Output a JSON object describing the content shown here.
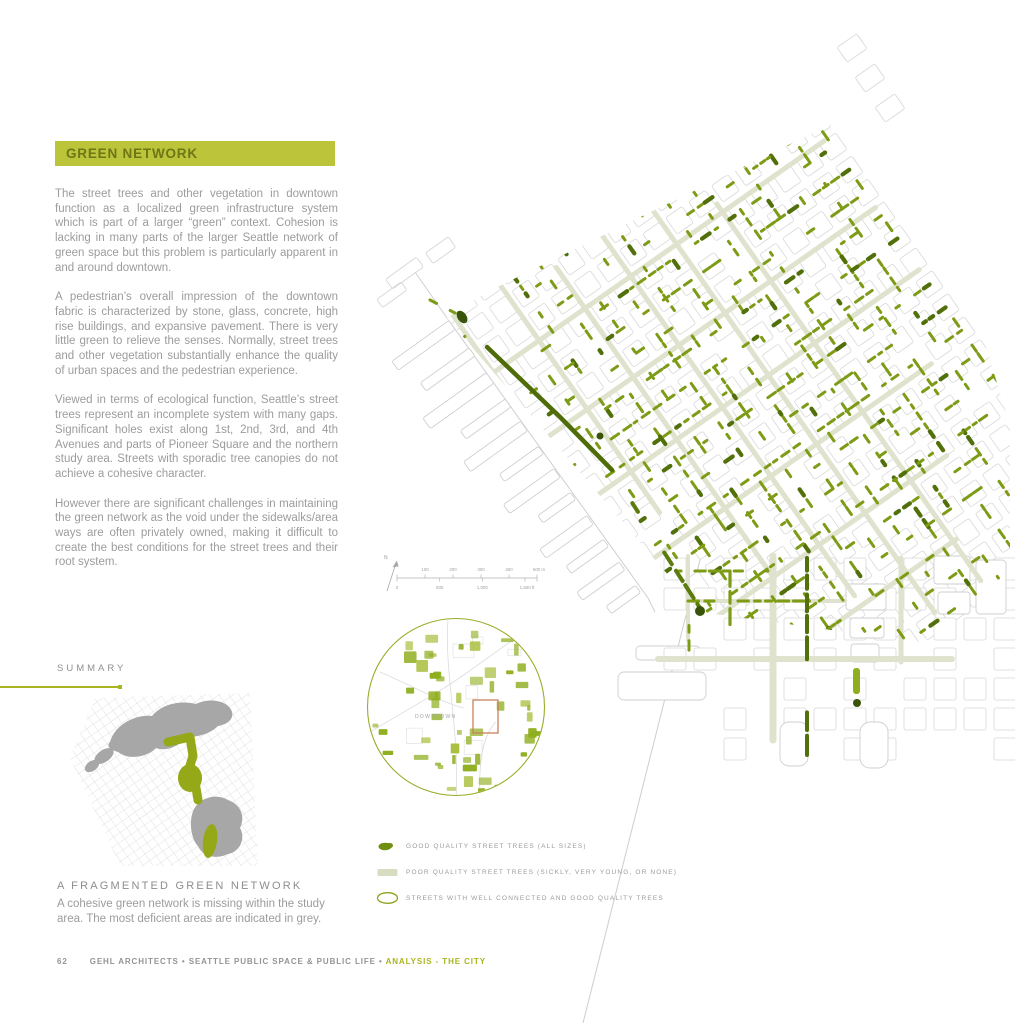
{
  "header": {
    "title": "GREEN NETWORK"
  },
  "article": {
    "paragraphs": [
      "The street trees and other vegetation in downtown function as a localized green infrastructure system which is part of a larger “green” context. Cohesion is lacking in many parts of the larger Seattle network of green space but this problem is particularly apparent in and around downtown.",
      "A pedestrian’s overall impression of the downtown fabric is characterized by stone, glass, concrete, high rise buildings, and expansive pavement. There is very little green to relieve the senses. Normally, street trees and other vegetation substantially enhance the quality of urban spaces and the pedestrian experience.",
      "Viewed in terms of ecological function, Seattle’s street trees represent an incomplete system with many gaps. Significant holes exist along 1st, 2nd, 3rd, and 4th Avenues and parts of Pioneer Square and the northern study area. Streets with sporadic tree canopies do not achieve a cohesive character.",
      "However there are significant challenges in maintaining the green network as the void under the sidewalks/area ways are often privately owned, making it difficult to create the best conditions for the street trees and their root system."
    ]
  },
  "summary": {
    "label": "SUMMARY",
    "caption_title": "A FRAGMENTED GREEN NETWORK",
    "caption_body": "A cohesive green network is missing within the study area. The most deficient areas are indicated in grey."
  },
  "map": {
    "scalebar": {
      "north_label": "N",
      "meters": [
        "100",
        "200",
        "300",
        "400",
        "500 m"
      ],
      "feet": [
        "0",
        "500",
        "1,000",
        "1,500 ft"
      ]
    },
    "inset": {
      "label": "DOWNTOWN"
    },
    "legend": [
      {
        "icon": "good-trees-blob-icon",
        "label": "GOOD QUALITY STREET TREES (ALL SIZES)"
      },
      {
        "icon": "poor-street-band-icon",
        "label": "POOR QUALITY STREET TREES (SICKLY, VERY YOUNG, OR NONE)"
      },
      {
        "icon": "connected-street-ellipse-icon",
        "label": "STREETS WITH WELL CONNECTED AND GOOD QUALITY TREES"
      }
    ]
  },
  "footer": {
    "page_number": "62",
    "text": "GEHL ARCHITECTS • SEATTLE PUBLIC SPACE & PUBLIC LIFE • ",
    "highlight": "ANALYSIS - THE CITY"
  },
  "colors": {
    "accent": "#bcc43a",
    "tree_good": "#7d9b15",
    "tree_good_dark": "#51700a",
    "tree_good_darkest": "#39540a",
    "street_poor": "#dfe3cd",
    "grid_grey": "#d8d8d8",
    "outline_grey": "#cfcfcf",
    "extent_box": "#c9815e",
    "inset_green": "#8fae1f",
    "summary_grey": "#a7a7a7",
    "summary_green": "#95a818"
  }
}
